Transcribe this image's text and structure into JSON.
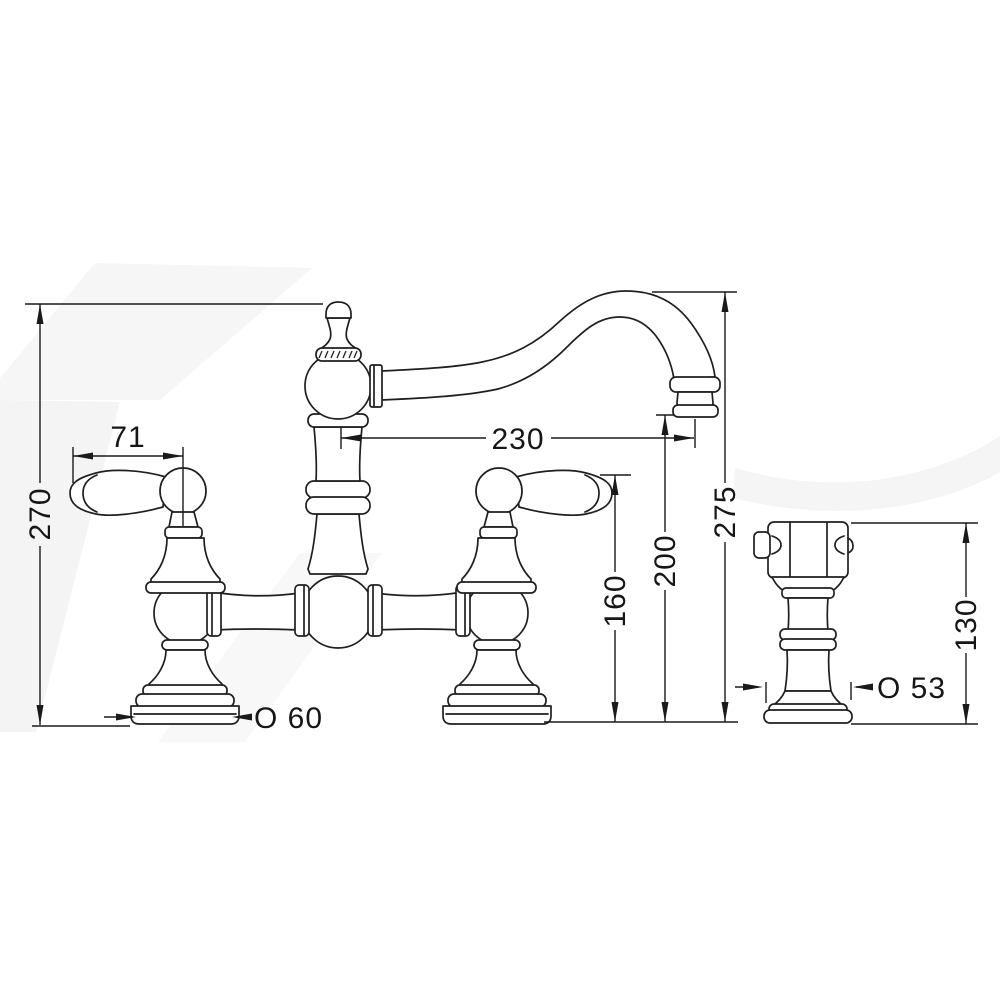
{
  "drawing": {
    "background_color": "#ffffff",
    "line_color": "#1f1f1f",
    "dimension_color": "#1a1a1a",
    "dims": {
      "overall_height": "270",
      "handle_length": "71",
      "spout_reach": "230",
      "spout_height": "275",
      "outlet_height": "200",
      "handle_height": "160",
      "sprayer_height": "130",
      "base_diameter": "O 60",
      "sprayer_base_diameter": "O 53"
    }
  }
}
